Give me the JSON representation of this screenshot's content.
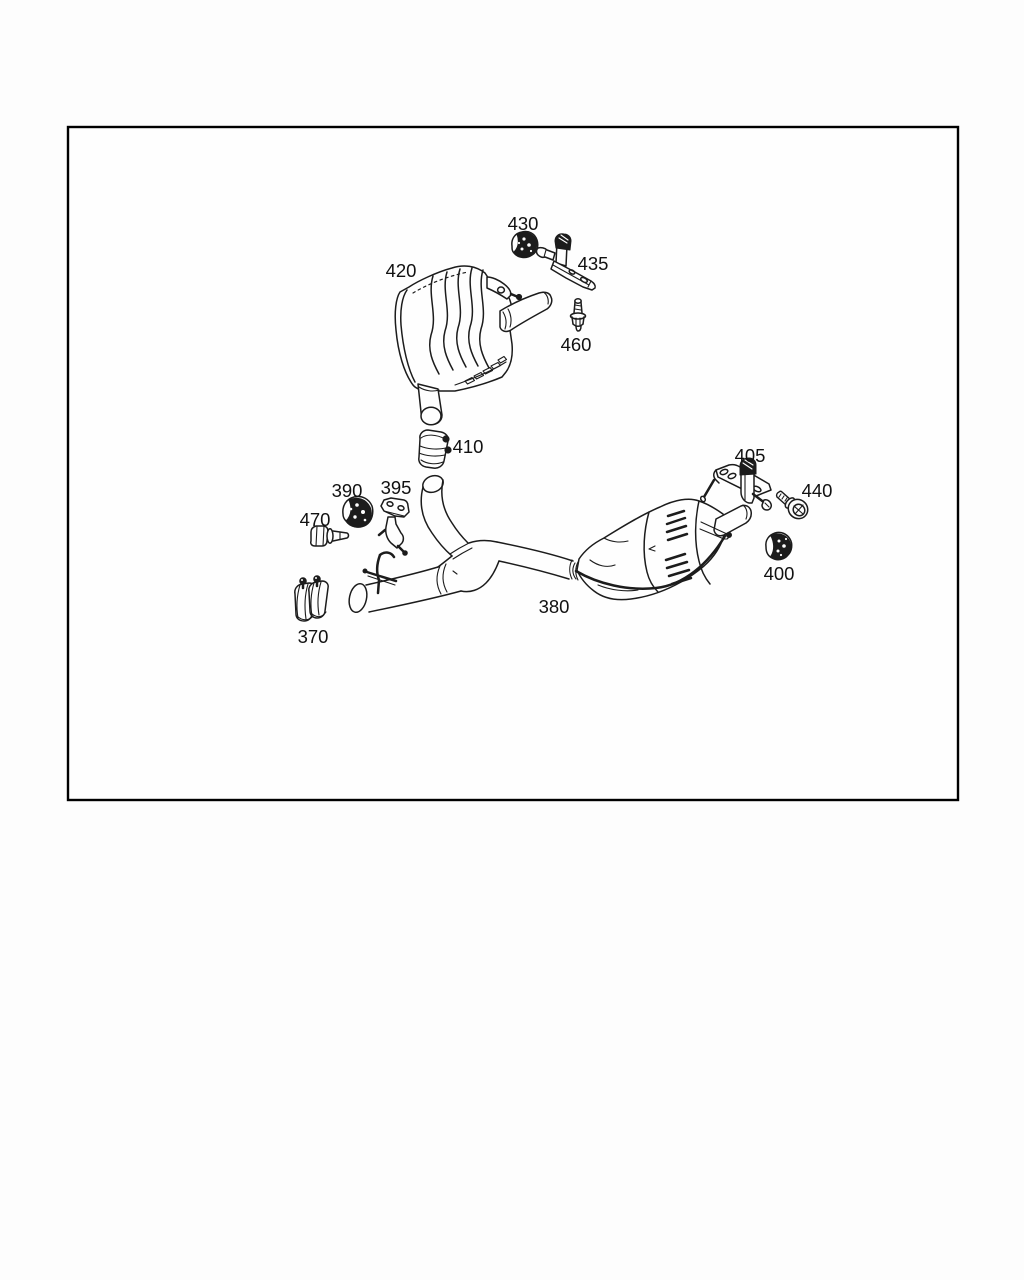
{
  "page": {
    "background": "#fdfdfd",
    "frame_fill": "#fefefe",
    "frame_border": "#000000",
    "line_color": "#1c1c1c"
  },
  "diagram": {
    "kind": "exploded-parts-diagram",
    "subject": "Exhaust system: two rear mufflers, center Y-pipe, clamps, brackets, bolts and rubber mounts",
    "labels": [
      {
        "part": "420",
        "text": "420",
        "x": 401,
        "y": 277
      },
      {
        "part": "430",
        "text": "430",
        "x": 523,
        "y": 230
      },
      {
        "part": "435",
        "text": "435",
        "x": 593,
        "y": 270
      },
      {
        "part": "460",
        "text": "460",
        "x": 576,
        "y": 351
      },
      {
        "part": "410",
        "text": "410",
        "x": 468,
        "y": 453
      },
      {
        "part": "405",
        "text": "405",
        "x": 750,
        "y": 462
      },
      {
        "part": "440",
        "text": "440",
        "x": 817,
        "y": 497
      },
      {
        "part": "390",
        "text": "390",
        "x": 347,
        "y": 497
      },
      {
        "part": "395",
        "text": "395",
        "x": 396,
        "y": 494
      },
      {
        "part": "470",
        "text": "470",
        "x": 315,
        "y": 526
      },
      {
        "part": "400",
        "text": "400",
        "x": 779,
        "y": 580
      },
      {
        "part": "380",
        "text": "380",
        "x": 554,
        "y": 613
      },
      {
        "part": "370",
        "text": "370",
        "x": 313,
        "y": 643
      }
    ]
  }
}
